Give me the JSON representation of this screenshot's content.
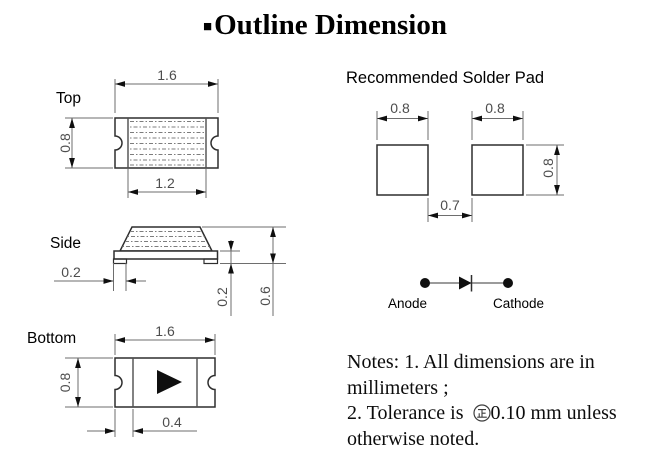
{
  "header": {
    "bullet": "■",
    "title": "Outline Dimension"
  },
  "views": {
    "top": {
      "label": "Top",
      "dims": {
        "width": "1.6",
        "height": "0.8",
        "inner_width": "1.2"
      }
    },
    "side": {
      "label": "Side",
      "dims": {
        "terminal": "0.2",
        "base_height": "0.2",
        "total_height": "0.6"
      }
    },
    "bottom": {
      "label": "Bottom",
      "dims": {
        "width": "1.6",
        "height": "0.8",
        "terminal_width": "0.4"
      }
    }
  },
  "solder_pad": {
    "title": "Recommended Solder Pad",
    "dims": {
      "pad_width_left": "0.8",
      "pad_width_right": "0.8",
      "pad_height": "0.8",
      "gap": "0.7"
    }
  },
  "polarity": {
    "anode_label": "Anode",
    "cathode_label": "Cathode"
  },
  "notes": {
    "line1": "Notes: 1. All dimensions are in",
    "line2": "millimeters ;",
    "line3_prefix": "2. Tolerance is",
    "line3_suffix": "0.10 mm unless",
    "line4": "otherwise noted.",
    "tolerance_symbol_icon": "circled-plus-minus"
  },
  "colors": {
    "background": "#ffffff",
    "outline": "#2e2e2e",
    "dim_line": "#6e6e6e",
    "dim_text": "#4d4d4d",
    "hatch": "#7d7d7d",
    "text": "#000000"
  }
}
